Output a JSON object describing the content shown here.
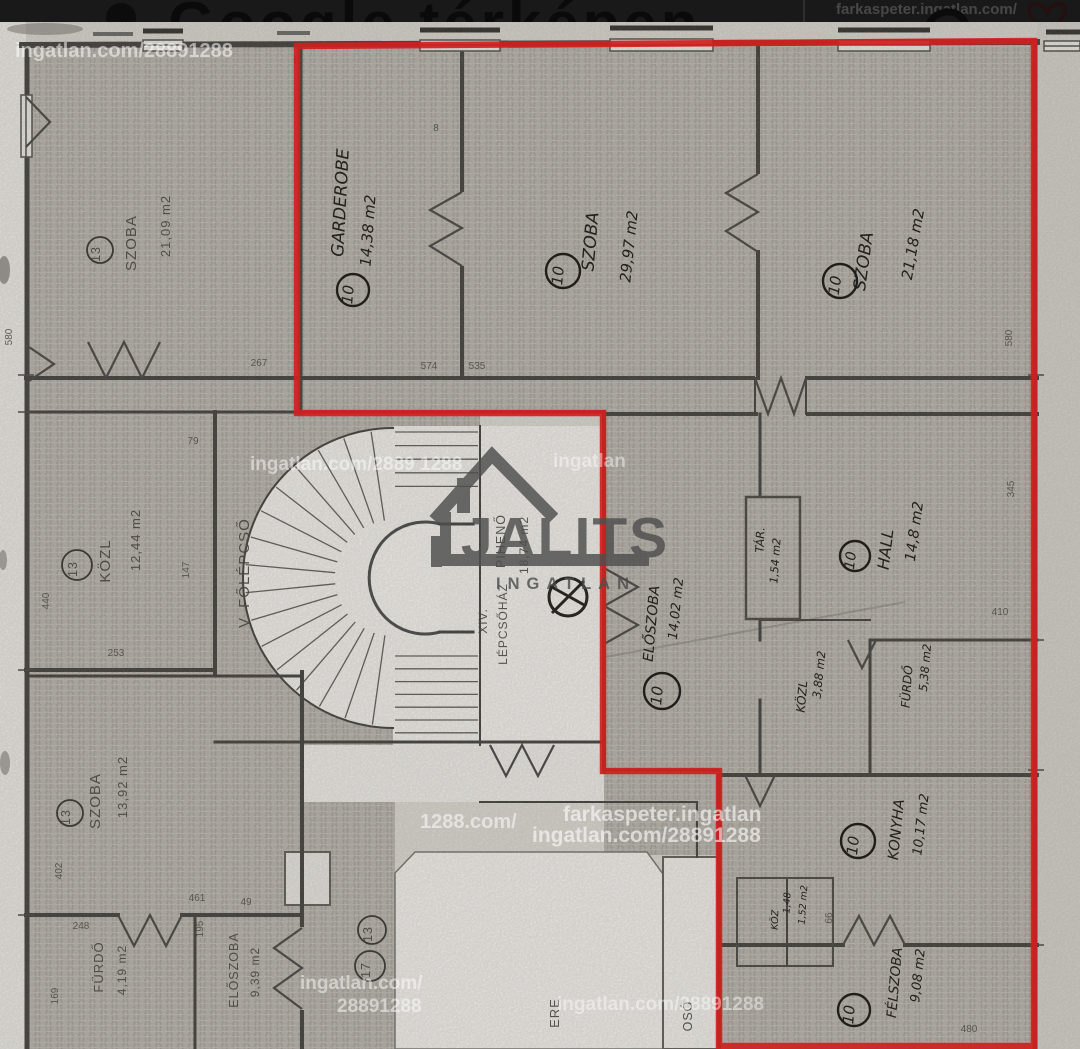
{
  "top_bar": {
    "title": "Google térképen",
    "watermark": "farkaspeter.ingatlan.com/",
    "icons": {
      "pin": "map-pin",
      "phone": "phone",
      "heart": "favorite-heart"
    }
  },
  "logo": {
    "brand": "JALITS",
    "subtitle": "INGATLAN"
  },
  "watermark": {
    "tile": "ingatlan.com/28891288",
    "agent": "farkaspeter.ingatlan",
    "frag_tile2": "ingatlan.com/2889 1288",
    "frag_1288": "1288.com/",
    "frag_ingatlan": "ingatlan",
    "frag_lan": "ingatlan.com/",
    "frag_num": "28891288"
  },
  "apartment_10": {
    "unit": "10",
    "rooms": {
      "garderobe": {
        "name": "GARDEROBE",
        "area": "14,38 m2"
      },
      "szoba_left": {
        "name": "SZOBA",
        "area": "29,97 m2"
      },
      "szoba_right": {
        "name": "SZOBA",
        "area": "21,18 m2"
      },
      "eloszoba": {
        "name": "ELŐSZOBA",
        "area": "14,02 m2"
      },
      "tar": {
        "name": "TÁR.",
        "area": "1,54 m2"
      },
      "hall": {
        "name": "HALL",
        "area": "14,8 m2"
      },
      "kozl": {
        "name": "KÖZL",
        "area": "3,88 m2"
      },
      "furdo": {
        "name": "FÜRDŐ",
        "area": "5,38 m2"
      },
      "konyha": {
        "name": "KONYHA",
        "area": "10,17 m2"
      },
      "felszoba": {
        "name": "FÉLSZOBA",
        "area": "9,08 m2"
      },
      "koz": {
        "name": "KÖZ",
        "area": "1,48"
      },
      "wc": {
        "area": "1,52 m2"
      }
    }
  },
  "apartment_13": {
    "unit": "13",
    "rooms": {
      "szoba_top": {
        "name": "SZOBA",
        "area": "21,09 m2"
      },
      "kozl": {
        "name": "KÖZL",
        "area": "12,44 m2"
      },
      "szoba_bottom": {
        "name": "SZOBA",
        "area": "13,92 m2"
      },
      "furdo": {
        "name": "FÜRDŐ",
        "area": "4,19 m2"
      },
      "eloszoba": {
        "name": "ELŐSZOBA",
        "area": "9,39 m2"
      }
    }
  },
  "apartment_17": {
    "unit": "17"
  },
  "common": {
    "main_stair": "V. FŐLÉPCSŐ",
    "stairwell_no": "XIV.",
    "stairwell": "LÉPCSŐHÁZ",
    "landing": "PIHENŐ",
    "landing_area": "18,74 m2",
    "courtyard_fragment": "ERE",
    "shaft_fragment": "OSÓ"
  },
  "dimensions": {
    "left_580": "580",
    "d267": "267",
    "d79": "79",
    "d8": "8",
    "d574": "574",
    "d535": "535",
    "d440": "440",
    "d147": "147",
    "d253": "253",
    "right_580": "580",
    "d345": "345",
    "d410": "410",
    "d402": "402",
    "d248": "248",
    "d49": "49",
    "d461": "461",
    "d195": "195",
    "d169": "169",
    "d66": "66",
    "d480": "480"
  },
  "colors": {
    "outline_red": "#d02020",
    "wall": "#34332f",
    "paper": "#dcd8d2",
    "room_shade": "#b4b0a9",
    "bar_bg": "#191919",
    "logo_gray": "#4e4e4e"
  }
}
